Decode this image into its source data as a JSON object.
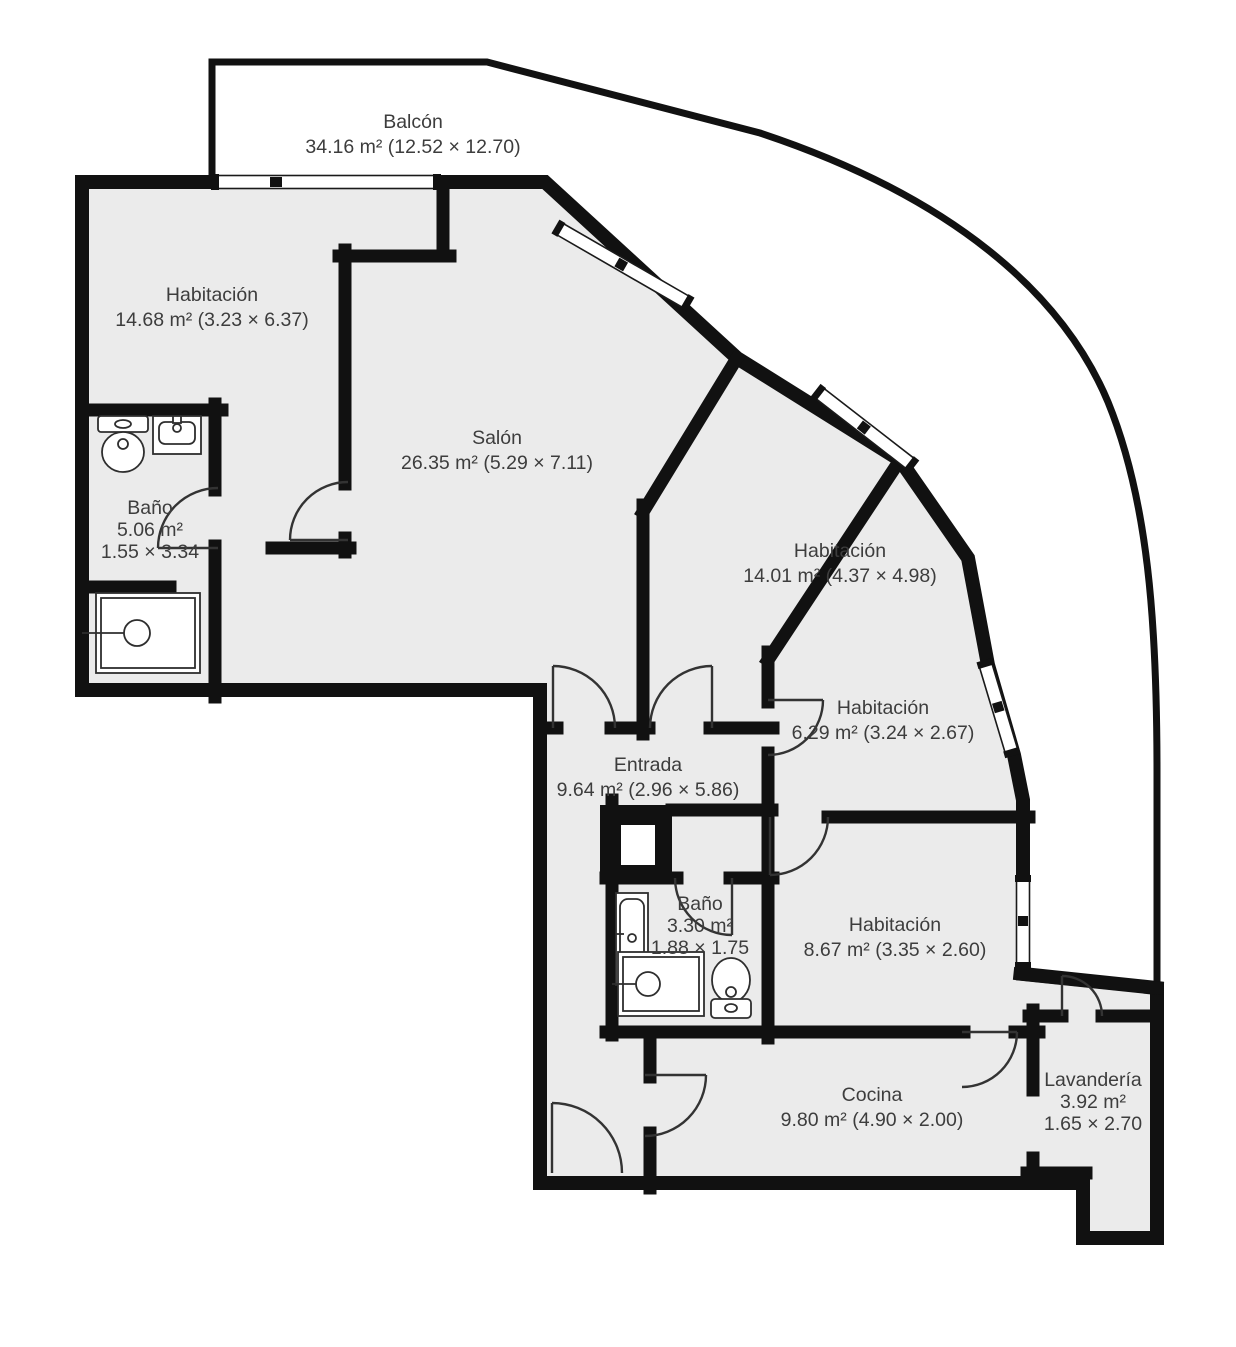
{
  "plan_title": "Floor plan",
  "rooms": {
    "balcon": {
      "name": "Balcón",
      "details": "34.16 m² (12.52 × 12.70)"
    },
    "habitacion_1": {
      "name": "Habitación",
      "details": "14.68 m² (3.23 × 6.37)"
    },
    "salon": {
      "name": "Salón",
      "details": "26.35 m² (5.29 × 7.11)"
    },
    "bano_1": {
      "name": "Baño",
      "area": "5.06 m²",
      "dims": "1.55 × 3.34"
    },
    "habitacion_2": {
      "name": "Habitación",
      "details": "14.01 m² (4.37 × 4.98)"
    },
    "habitacion_3": {
      "name": "Habitación",
      "details": "6.29 m² (3.24 × 2.67)"
    },
    "entrada": {
      "name": "Entrada",
      "details": "9.64 m² (2.96 × 5.86)"
    },
    "bano_2": {
      "name": "Baño",
      "area": "3.30 m²",
      "dims": "1.88 × 1.75"
    },
    "habitacion_4": {
      "name": "Habitación",
      "details": "8.67 m² (3.35 × 2.60)"
    },
    "cocina": {
      "name": "Cocina",
      "details": "9.80 m² (4.90 × 2.00)"
    },
    "lavanderia": {
      "name": "Lavandería",
      "area": "3.92 m²",
      "dims": "1.65 × 2.70"
    }
  },
  "colors": {
    "wall": "#111111",
    "room_fill": "#ebebeb",
    "label": "#3d3d3d",
    "door_arc": "#333333",
    "fixture_stroke": "#2e2e2e",
    "window_frame": "#1a1a1a",
    "background": "#ffffff"
  }
}
